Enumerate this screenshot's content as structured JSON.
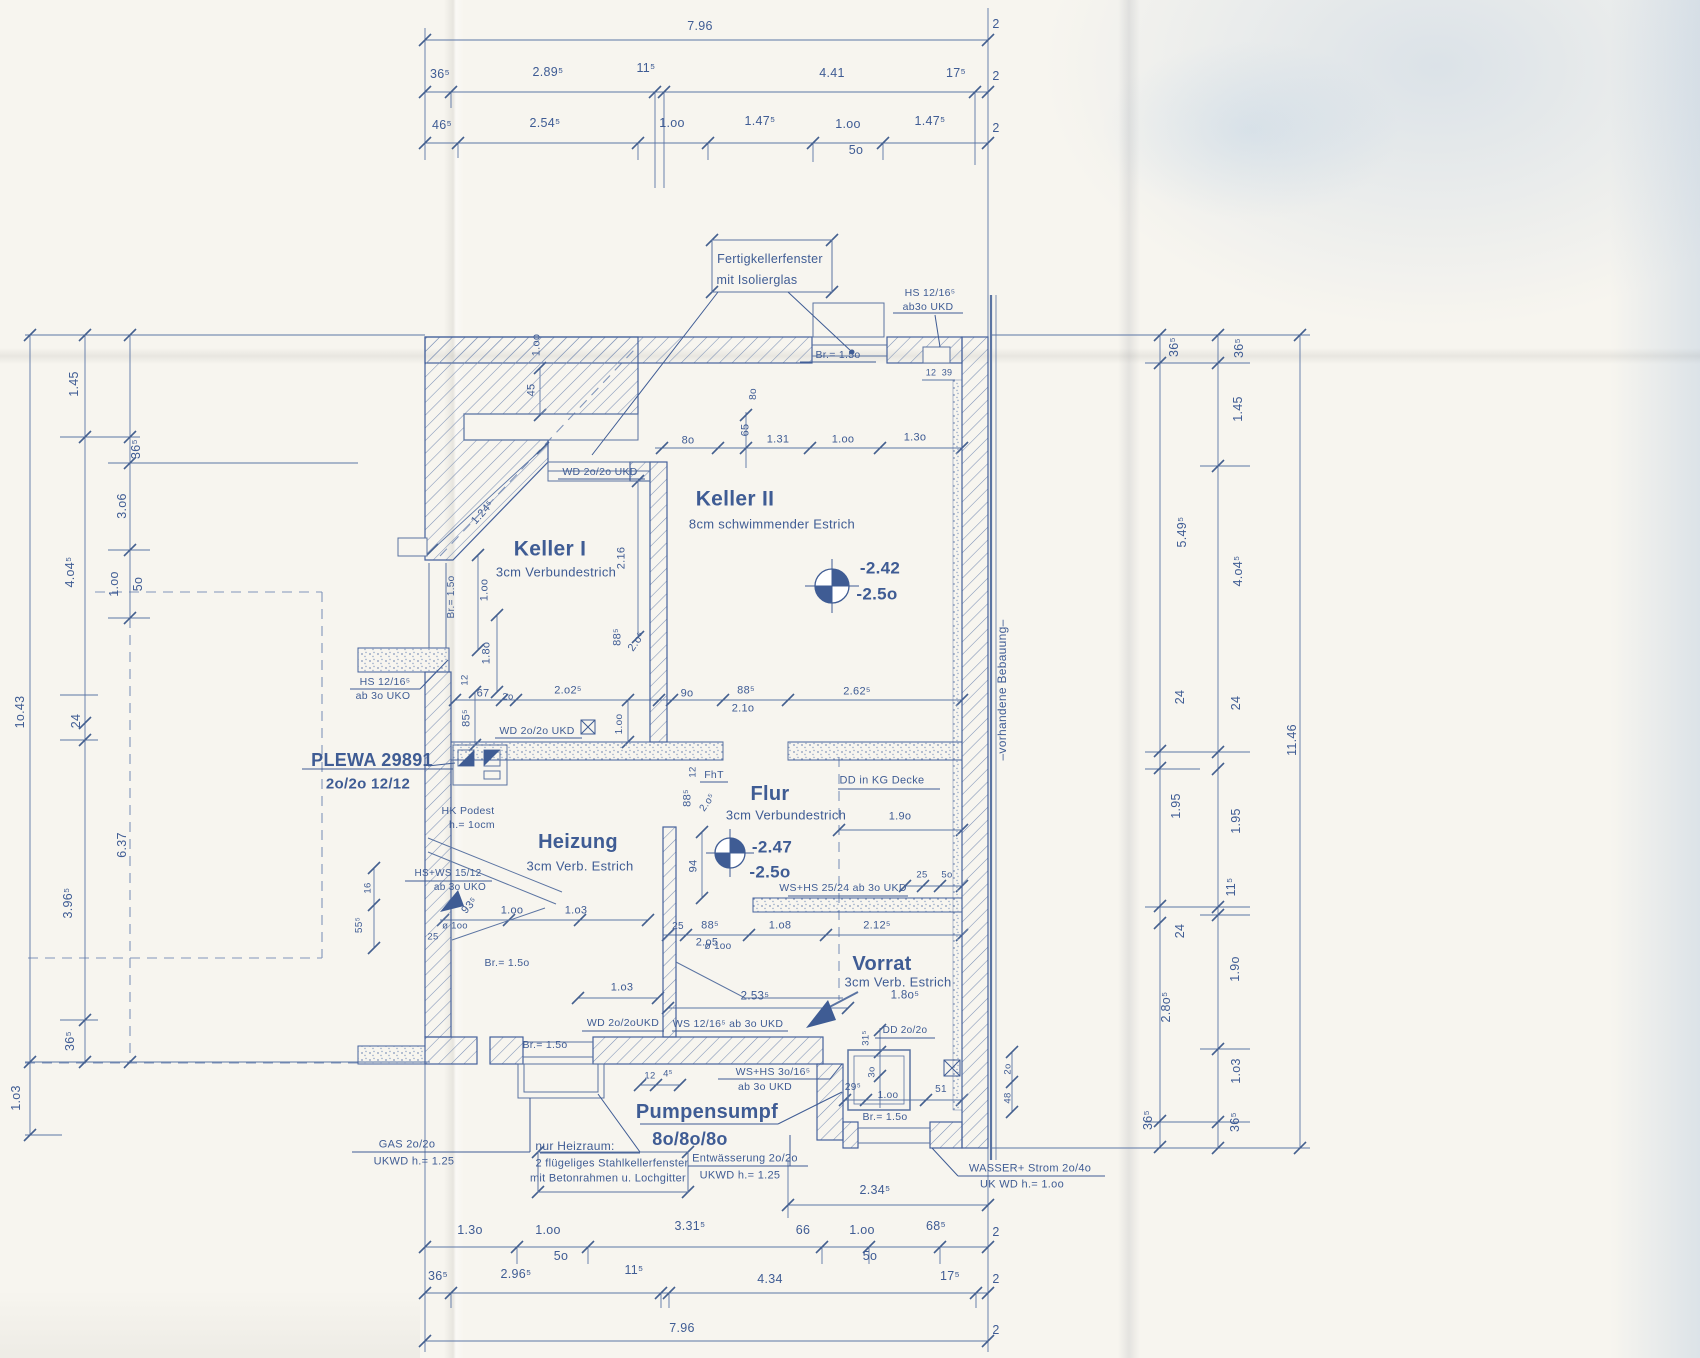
{
  "document": {
    "kind": "scanned basement floor plan blueprint",
    "ink_color": "#3f5c94",
    "paper_color": "#f7f5ef"
  },
  "dimensions": {
    "top": [
      {
        "x": 700,
        "y": 26,
        "t": "7.96"
      },
      {
        "x": 996,
        "y": 24,
        "t": "2"
      },
      {
        "x": 440,
        "y": 74,
        "t": "36⁵"
      },
      {
        "x": 548,
        "y": 72,
        "t": "2.89⁵"
      },
      {
        "x": 646,
        "y": 68,
        "t": "11⁵"
      },
      {
        "x": 832,
        "y": 73,
        "t": "4.41"
      },
      {
        "x": 956,
        "y": 73,
        "t": "17⁵"
      },
      {
        "x": 996,
        "y": 76,
        "t": "2"
      },
      {
        "x": 442,
        "y": 125,
        "t": "46⁵"
      },
      {
        "x": 545,
        "y": 123,
        "t": "2.54⁵"
      },
      {
        "x": 672,
        "y": 123,
        "t": "1.oo"
      },
      {
        "x": 760,
        "y": 121,
        "t": "1.47⁵"
      },
      {
        "x": 848,
        "y": 124,
        "t": "1.oo"
      },
      {
        "x": 856,
        "y": 150,
        "t": "5o"
      },
      {
        "x": 930,
        "y": 121,
        "t": "1.47⁵"
      },
      {
        "x": 996,
        "y": 128,
        "t": "2"
      }
    ],
    "bottom": [
      {
        "x": 875,
        "y": 1190,
        "t": "2.34⁵"
      },
      {
        "x": 470,
        "y": 1230,
        "t": "1.3o"
      },
      {
        "x": 548,
        "y": 1230,
        "t": "1.oo"
      },
      {
        "x": 561,
        "y": 1256,
        "t": "5o"
      },
      {
        "x": 690,
        "y": 1226,
        "t": "3.31⁵"
      },
      {
        "x": 803,
        "y": 1230,
        "t": "66"
      },
      {
        "x": 862,
        "y": 1230,
        "t": "1.oo"
      },
      {
        "x": 870,
        "y": 1256,
        "t": "5o"
      },
      {
        "x": 936,
        "y": 1226,
        "t": "68⁵"
      },
      {
        "x": 996,
        "y": 1232,
        "t": "2"
      },
      {
        "x": 438,
        "y": 1276,
        "t": "36⁵"
      },
      {
        "x": 516,
        "y": 1274,
        "t": "2.96⁵"
      },
      {
        "x": 634,
        "y": 1270,
        "t": "11⁵"
      },
      {
        "x": 770,
        "y": 1279,
        "t": "4.34"
      },
      {
        "x": 950,
        "y": 1276,
        "t": "17⁵"
      },
      {
        "x": 996,
        "y": 1279,
        "t": "2"
      },
      {
        "x": 682,
        "y": 1328,
        "t": "7.96"
      },
      {
        "x": 996,
        "y": 1330,
        "t": "2"
      }
    ],
    "left": [
      {
        "x": 20,
        "y": 712,
        "t": "1o.43",
        "r": -90
      },
      {
        "x": 16,
        "y": 1098,
        "t": "1.o3",
        "r": -90
      },
      {
        "x": 74,
        "y": 384,
        "t": "1.45",
        "r": -90
      },
      {
        "x": 70,
        "y": 572,
        "t": "4.o4⁵",
        "r": -90
      },
      {
        "x": 76,
        "y": 721,
        "t": "24",
        "r": -90
      },
      {
        "x": 68,
        "y": 903,
        "t": "3.96⁵",
        "r": -90
      },
      {
        "x": 70,
        "y": 1041,
        "t": "36⁵",
        "r": -90
      },
      {
        "x": 136,
        "y": 449,
        "t": "36⁵",
        "r": -90
      },
      {
        "x": 122,
        "y": 506,
        "t": "3.o6",
        "r": -90
      },
      {
        "x": 114,
        "y": 584,
        "t": "1.oo",
        "r": -90
      },
      {
        "x": 138,
        "y": 584,
        "t": "5o",
        "r": -90
      },
      {
        "x": 122,
        "y": 845,
        "t": "6.37",
        "r": -90
      }
    ],
    "right": [
      {
        "x": 1174,
        "y": 347,
        "t": "36⁵",
        "r": -90
      },
      {
        "x": 1182,
        "y": 532,
        "t": "5.49⁵",
        "r": -90
      },
      {
        "x": 1180,
        "y": 697,
        "t": "24",
        "r": -90
      },
      {
        "x": 1176,
        "y": 806,
        "t": "1.95",
        "r": -90
      },
      {
        "x": 1180,
        "y": 931,
        "t": "24",
        "r": -90
      },
      {
        "x": 1166,
        "y": 1007,
        "t": "2.8o⁵",
        "r": -90
      },
      {
        "x": 1148,
        "y": 1120,
        "t": "36⁵",
        "r": -90
      },
      {
        "x": 1239,
        "y": 348,
        "t": "36⁵",
        "r": -90
      },
      {
        "x": 1238,
        "y": 409,
        "t": "1.45",
        "r": -90
      },
      {
        "x": 1238,
        "y": 571,
        "t": "4.o4⁵",
        "r": -90
      },
      {
        "x": 1236,
        "y": 703,
        "t": "24",
        "r": -90
      },
      {
        "x": 1236,
        "y": 821,
        "t": "1.95",
        "r": -90
      },
      {
        "x": 1231,
        "y": 887,
        "t": "11⁵",
        "r": -90
      },
      {
        "x": 1235,
        "y": 969,
        "t": "1.9o",
        "r": -90
      },
      {
        "x": 1236,
        "y": 1071,
        "t": "1.o3",
        "r": -90
      },
      {
        "x": 1235,
        "y": 1122,
        "t": "36⁵",
        "r": -90
      },
      {
        "x": 1292,
        "y": 740,
        "t": "11.46",
        "r": -90
      }
    ],
    "interior": [
      {
        "x": 688,
        "y": 441,
        "t": "8o",
        "s": 11
      },
      {
        "x": 778,
        "y": 440,
        "t": "1.31",
        "s": 11
      },
      {
        "x": 843,
        "y": 440,
        "t": "1.oo",
        "s": 11
      },
      {
        "x": 915,
        "y": 438,
        "t": "1.3o",
        "s": 11
      },
      {
        "x": 746,
        "y": 430,
        "t": "65",
        "r": -90,
        "s": 11
      },
      {
        "x": 754,
        "y": 394,
        "t": "8o",
        "r": -90,
        "s": 10
      },
      {
        "x": 537,
        "y": 345,
        "t": "1.oo",
        "r": -90,
        "s": 11
      },
      {
        "x": 532,
        "y": 390,
        "t": "45",
        "r": -90,
        "s": 11
      },
      {
        "x": 622,
        "y": 558,
        "t": "2.16",
        "r": -90,
        "s": 11
      },
      {
        "x": 483,
        "y": 513,
        "t": "1.24⁵",
        "r": -48,
        "s": 11
      },
      {
        "x": 452,
        "y": 597,
        "t": "Br.= 1.5o",
        "r": -90,
        "s": 10
      },
      {
        "x": 485,
        "y": 590,
        "t": "1.oo",
        "r": -90,
        "s": 11
      },
      {
        "x": 487,
        "y": 653,
        "t": "1.8o",
        "r": -90,
        "s": 11
      },
      {
        "x": 467,
        "y": 718,
        "t": "85⁵",
        "r": -90,
        "s": 11
      },
      {
        "x": 465,
        "y": 680,
        "t": "12",
        "r": -90,
        "s": 9.5
      },
      {
        "x": 483,
        "y": 694,
        "t": "67",
        "s": 11
      },
      {
        "x": 508,
        "y": 697,
        "t": "2o",
        "s": 9.5
      },
      {
        "x": 568,
        "y": 691,
        "t": "2.o2⁵",
        "s": 11
      },
      {
        "x": 618,
        "y": 637,
        "t": "88⁵",
        "r": -90,
        "s": 11
      },
      {
        "x": 637,
        "y": 642,
        "t": "2.o⁵",
        "r": -55,
        "s": 11
      },
      {
        "x": 687,
        "y": 694,
        "t": "9o",
        "s": 11
      },
      {
        "x": 746,
        "y": 691,
        "t": "88⁵",
        "s": 11
      },
      {
        "x": 743,
        "y": 709,
        "t": "2.1o",
        "s": 11
      },
      {
        "x": 857,
        "y": 692,
        "t": "2.62⁵",
        "s": 11
      },
      {
        "x": 620,
        "y": 724,
        "t": "1.oo",
        "r": -90,
        "s": 10
      },
      {
        "x": 693,
        "y": 772,
        "t": "12",
        "r": -90,
        "s": 9.5
      },
      {
        "x": 688,
        "y": 798,
        "t": "88⁵",
        "r": -90,
        "s": 11
      },
      {
        "x": 708,
        "y": 803,
        "t": "2.o⁵",
        "r": -55,
        "s": 10
      },
      {
        "x": 900,
        "y": 817,
        "t": "1.9o",
        "s": 11
      },
      {
        "x": 694,
        "y": 866,
        "t": "94",
        "r": -90,
        "s": 11
      },
      {
        "x": 922,
        "y": 875,
        "t": "25",
        "s": 9.5
      },
      {
        "x": 947,
        "y": 875,
        "t": "5o",
        "s": 9.5
      },
      {
        "x": 678,
        "y": 927,
        "t": "25",
        "s": 10
      },
      {
        "x": 710,
        "y": 926,
        "t": "88⁵",
        "s": 11
      },
      {
        "x": 707,
        "y": 943,
        "t": "2.o5",
        "s": 11
      },
      {
        "x": 780,
        "y": 926,
        "t": "1.o8",
        "s": 11
      },
      {
        "x": 877,
        "y": 926,
        "t": "2.12⁵",
        "s": 11
      },
      {
        "x": 718,
        "y": 947,
        "t": "ø 1oo",
        "s": 10
      },
      {
        "x": 470,
        "y": 906,
        "t": "93⁵",
        "r": -48,
        "s": 11
      },
      {
        "x": 512,
        "y": 911,
        "t": "1.oo",
        "s": 11
      },
      {
        "x": 576,
        "y": 911,
        "t": "1.o3",
        "s": 11
      },
      {
        "x": 433,
        "y": 937,
        "t": "25",
        "s": 9.5
      },
      {
        "x": 455,
        "y": 926,
        "t": "ø 1oo",
        "s": 9.5
      },
      {
        "x": 368,
        "y": 888,
        "t": "16",
        "r": -90,
        "s": 9.5
      },
      {
        "x": 360,
        "y": 925,
        "t": "55⁵",
        "r": -90,
        "s": 10
      },
      {
        "x": 755,
        "y": 997,
        "t": "2.53⁵",
        "s": 11.5
      },
      {
        "x": 622,
        "y": 988,
        "t": "1.o3",
        "s": 11
      },
      {
        "x": 905,
        "y": 996,
        "t": "1.8o⁵",
        "s": 11.5
      },
      {
        "x": 650,
        "y": 1076,
        "t": "12",
        "s": 9.5
      },
      {
        "x": 668,
        "y": 1074,
        "t": "4⁵",
        "s": 9.5
      },
      {
        "x": 866,
        "y": 1038,
        "t": "31⁵",
        "r": -90,
        "s": 9.5
      },
      {
        "x": 872,
        "y": 1072,
        "t": "3o",
        "r": -90,
        "s": 9.5
      },
      {
        "x": 853,
        "y": 1088,
        "t": "29⁵",
        "s": 10
      },
      {
        "x": 888,
        "y": 1096,
        "t": "1.oo",
        "s": 10
      },
      {
        "x": 941,
        "y": 1090,
        "t": "51",
        "s": 10
      },
      {
        "x": 1008,
        "y": 1069,
        "t": "2o",
        "r": -90,
        "s": 9.5
      },
      {
        "x": 1008,
        "y": 1098,
        "t": "48",
        "r": -90,
        "s": 9.5
      },
      {
        "x": 931,
        "y": 373,
        "t": "12",
        "s": 9
      },
      {
        "x": 947,
        "y": 373,
        "t": "39",
        "s": 9
      }
    ]
  },
  "rooms": [
    {
      "x": 550,
      "y": 549,
      "t": "Keller I",
      "s": 21,
      "b": 1
    },
    {
      "x": 556,
      "y": 572,
      "t": "3cm Verbundestrich",
      "s": 13
    },
    {
      "x": 735,
      "y": 499,
      "t": "Keller II",
      "s": 21,
      "b": 1
    },
    {
      "x": 772,
      "y": 524,
      "t": "8cm schwimmender  Estrich",
      "s": 13
    },
    {
      "x": 578,
      "y": 842,
      "t": "Heizung",
      "s": 20,
      "b": 1
    },
    {
      "x": 580,
      "y": 866,
      "t": "3cm  Verb. Estrich",
      "s": 13
    },
    {
      "x": 770,
      "y": 794,
      "t": "Flur",
      "s": 20,
      "b": 1
    },
    {
      "x": 786,
      "y": 815,
      "t": "3cm Verbundestrich",
      "s": 13
    },
    {
      "x": 882,
      "y": 964,
      "t": "Vorrat",
      "s": 20,
      "b": 1
    },
    {
      "x": 898,
      "y": 982,
      "t": "3cm Verb. Estrich",
      "s": 13
    },
    {
      "x": 707,
      "y": 1112,
      "t": "Pumpensumpf",
      "s": 20,
      "b": 1
    },
    {
      "x": 690,
      "y": 1139,
      "t": "8o/8o/8o",
      "s": 18,
      "b": 1
    },
    {
      "x": 372,
      "y": 760,
      "t": "PLEWA 29891",
      "s": 18,
      "b": 1
    },
    {
      "x": 368,
      "y": 784,
      "t": "2o/2o   12/12",
      "s": 15,
      "b": 1
    }
  ],
  "levels": [
    {
      "x": 880,
      "y": 568,
      "t": "-2.42",
      "s": 17,
      "b": 1
    },
    {
      "x": 877,
      "y": 594,
      "t": "-2.5o",
      "s": 17,
      "b": 1
    },
    {
      "x": 772,
      "y": 847,
      "t": "-2.47",
      "s": 17,
      "b": 1
    },
    {
      "x": 770,
      "y": 872,
      "t": "-2.5o",
      "s": 17,
      "b": 1
    }
  ],
  "annotations": [
    {
      "x": 770,
      "y": 259,
      "t": "Fertigkellerfenster",
      "s": 12.5
    },
    {
      "x": 757,
      "y": 280,
      "t": "mit Isolierglas",
      "s": 12.5
    },
    {
      "x": 930,
      "y": 293,
      "t": "HS 12/16⁵",
      "s": 10.5
    },
    {
      "x": 928,
      "y": 307,
      "t": "ab3o UKD",
      "s": 10.5
    },
    {
      "x": 838,
      "y": 355,
      "t": "Br.= 1.5o",
      "s": 10.5
    },
    {
      "x": 600,
      "y": 472,
      "t": "WD 2o/2o UKD",
      "s": 10.5
    },
    {
      "x": 385,
      "y": 682,
      "t": "HS 12/16⁵",
      "s": 10.5
    },
    {
      "x": 383,
      "y": 696,
      "t": "ab 3o UKO",
      "s": 10.5
    },
    {
      "x": 537,
      "y": 731,
      "t": "WD  2o/2o UKD",
      "s": 10.5
    },
    {
      "x": 882,
      "y": 781,
      "t": "DD in KG Decke",
      "s": 11
    },
    {
      "x": 843,
      "y": 888,
      "t": "WS+HS  25/24 ab 3o UKD",
      "s": 10.5
    },
    {
      "x": 468,
      "y": 811,
      "t": "HK Podest",
      "s": 10.5
    },
    {
      "x": 472,
      "y": 825,
      "t": "h.= 1ocm",
      "s": 10.5
    },
    {
      "x": 448,
      "y": 874,
      "t": "HS+WS 15/12",
      "s": 10
    },
    {
      "x": 460,
      "y": 888,
      "t": "ab 3o UKO",
      "s": 10
    },
    {
      "x": 507,
      "y": 963,
      "t": "Br.= 1.5o",
      "s": 10.5
    },
    {
      "x": 728,
      "y": 1024,
      "t": "WS 12/16⁵ ab 3o UKD",
      "s": 10.5
    },
    {
      "x": 623,
      "y": 1023,
      "t": "WD 2o/2oUKD",
      "s": 10.5
    },
    {
      "x": 773,
      "y": 1072,
      "t": "WS+HS  3o/16⁵",
      "s": 10.5
    },
    {
      "x": 765,
      "y": 1087,
      "t": "ab 3o UKD",
      "s": 10.5
    },
    {
      "x": 905,
      "y": 1031,
      "t": "DD  2o/2o",
      "s": 10
    },
    {
      "x": 885,
      "y": 1117,
      "t": "Br.= 1.5o",
      "s": 10.5
    },
    {
      "x": 545,
      "y": 1045,
      "t": "Br.= 1.5o",
      "s": 10.5
    },
    {
      "x": 407,
      "y": 1145,
      "t": "GAS  2o/2o",
      "s": 11
    },
    {
      "x": 414,
      "y": 1162,
      "t": "UKWD  h.= 1.25",
      "s": 11
    },
    {
      "x": 575,
      "y": 1146,
      "t": "nur Heizraum:",
      "s": 12
    },
    {
      "x": 612,
      "y": 1164,
      "t": "2 flügeliges  Stahlkellerfenster",
      "s": 11
    },
    {
      "x": 608,
      "y": 1179,
      "t": "mit Betonrahmen u. Lochgitter",
      "s": 11
    },
    {
      "x": 745,
      "y": 1159,
      "t": "Entwässerung   2o/2o",
      "s": 11
    },
    {
      "x": 740,
      "y": 1176,
      "t": "UKWD   h.= 1.25",
      "s": 11
    },
    {
      "x": 1030,
      "y": 1169,
      "t": "WASSER+ Strom   2o/4o",
      "s": 11
    },
    {
      "x": 1022,
      "y": 1185,
      "t": "UK WD  h.= 1.oo",
      "s": 11
    },
    {
      "x": 1002,
      "y": 690,
      "t": "–vorhandene Bebauung–",
      "r": -90,
      "s": 12
    },
    {
      "x": 714,
      "y": 775,
      "t": "FhT",
      "s": 10.5
    }
  ]
}
